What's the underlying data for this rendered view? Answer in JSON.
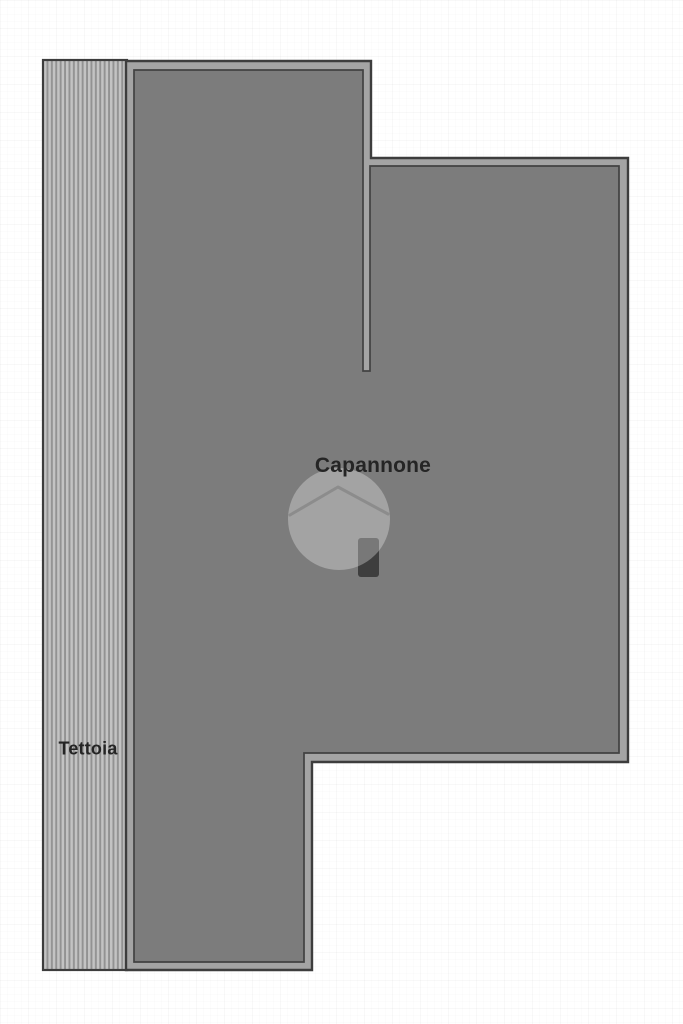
{
  "plan": {
    "areas": {
      "capannone": {
        "label": "Capannone"
      },
      "tettoia": {
        "label": "Tettoia"
      }
    },
    "watermark": {
      "icon": "house-in-circle",
      "opacity": "0.3"
    },
    "colors": {
      "background": "#ffffff",
      "outline": "#3d3d3d",
      "border-band": "#a4a4a4",
      "roof-fill": "#7c7c7c",
      "inner-line": "#424242",
      "stripe-light": "#c3c3c3",
      "stripe-dark": "#929292",
      "marker": "#3e3e3e",
      "label-color": "#252525",
      "watermark-fill": "#ffffff"
    }
  }
}
